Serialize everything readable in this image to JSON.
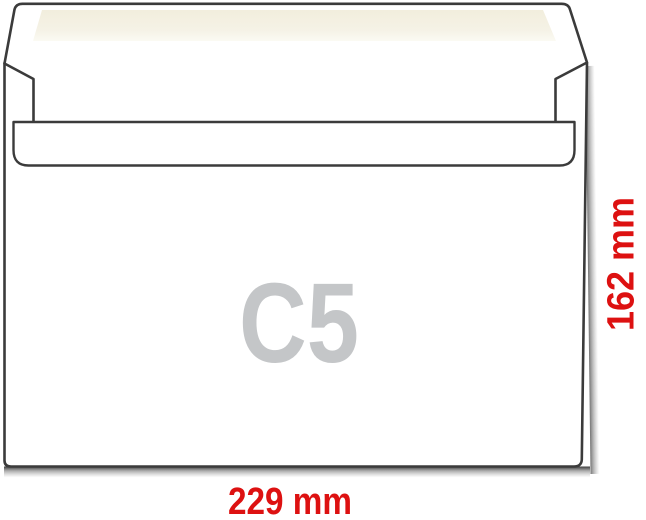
{
  "diagram": {
    "title": "C5 envelope size diagram",
    "format_label": "C5",
    "width_label": "229 mm",
    "height_label": "162 mm"
  },
  "colors": {
    "outline": "#3b3b3b",
    "paper_white": "#ffffff",
    "adhesive_cream": "#f4f1e3",
    "format_gray": "#c4c6c8",
    "dimension_red": "#dd1111",
    "shadow_gray": "#8c8c8c"
  }
}
